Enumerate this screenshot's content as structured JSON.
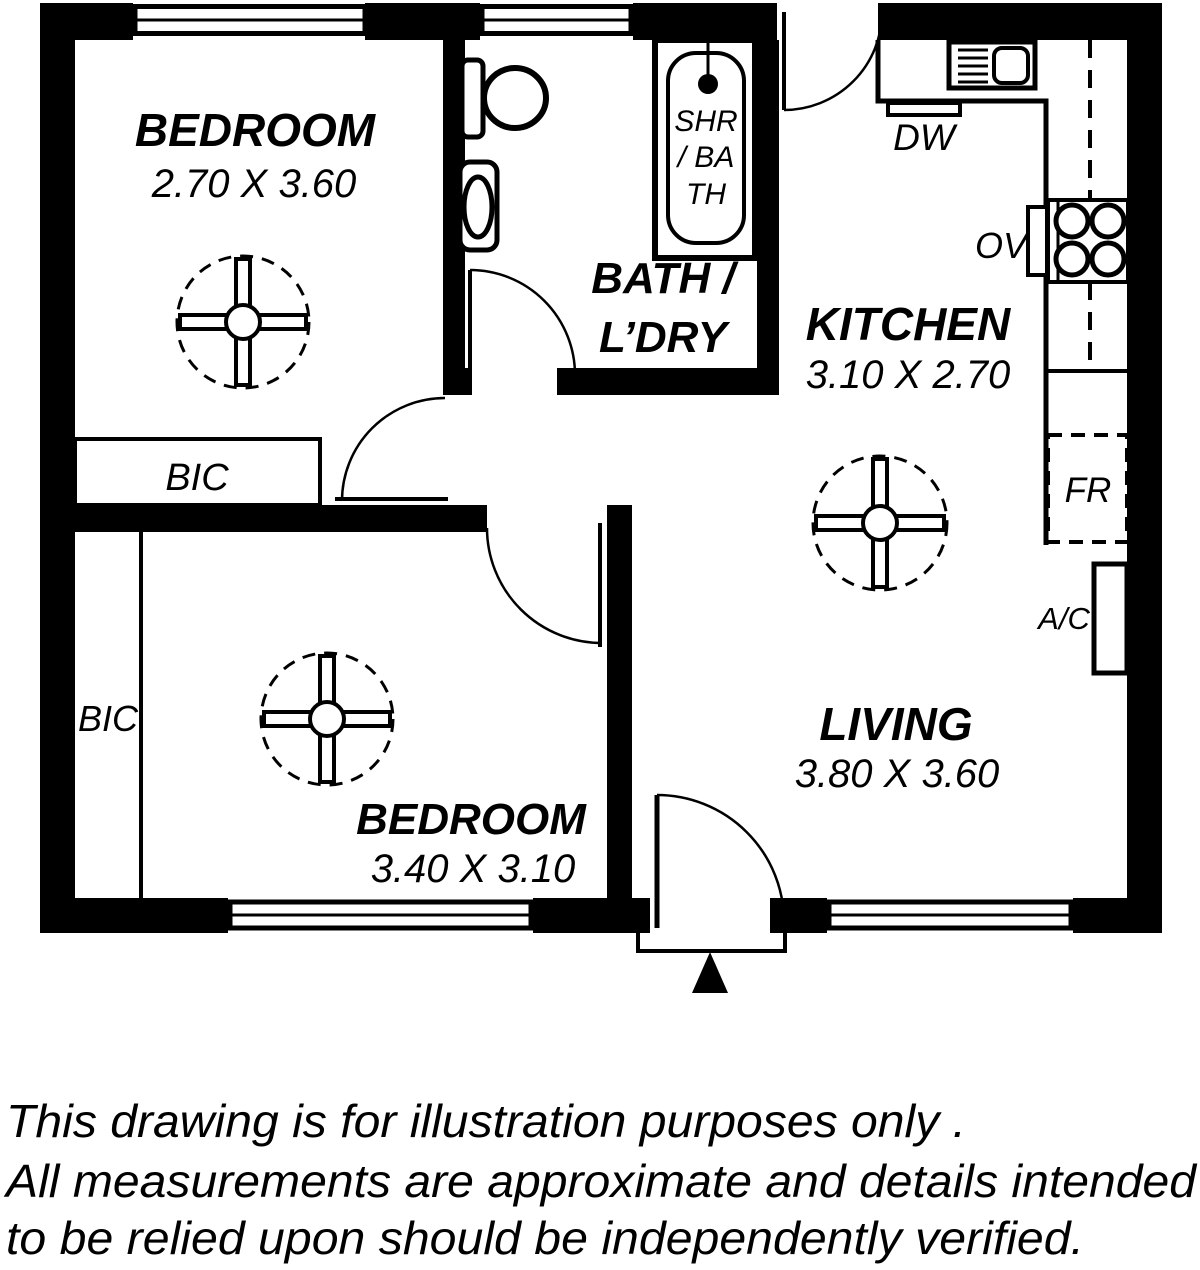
{
  "plan": {
    "rooms": [
      {
        "label": "BEDROOM",
        "dims": "2.70 X 3.60"
      },
      {
        "label": "BEDROOM",
        "dims": "3.40 X 3.10"
      },
      {
        "label": "KITCHEN",
        "dims": "3.10 X 2.70"
      },
      {
        "label": "LIVING",
        "dims": "3.80 X 3.60"
      },
      {
        "label_line1": "BATH /",
        "label_line2": "L’DRY"
      }
    ],
    "fixtures": {
      "dishwasher": "DW",
      "oven": "OV",
      "fridge": "FR",
      "air_conditioner": "A/C",
      "cupboard_bedroom1": "BIC",
      "cupboard_bedroom2": "BIC",
      "shower_bath_lines": [
        "SHR",
        "/ BA",
        "TH"
      ]
    },
    "entry": {
      "arrow_symbol": "▲"
    }
  },
  "disclaimer": {
    "lines": [
      "This drawing is for illustration purposes only .",
      "All measurements are approximate and details intended",
      "to be relied upon should be independently verified."
    ]
  },
  "colors": {
    "ink": "#000000",
    "paper": "#ffffff"
  }
}
